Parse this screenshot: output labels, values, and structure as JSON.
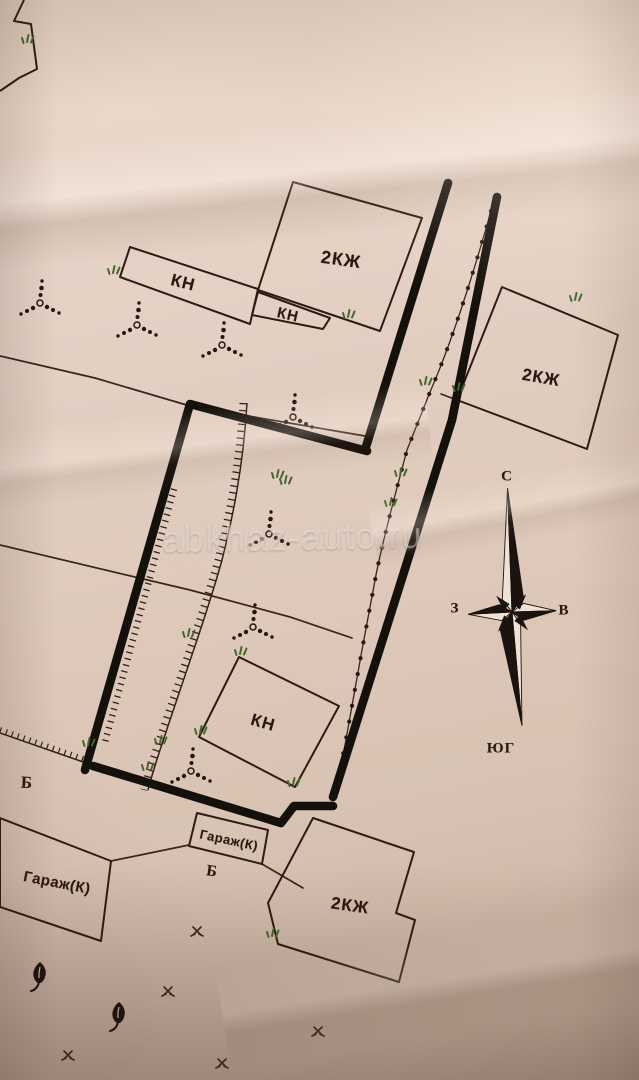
{
  "document": {
    "kind_visible": "hand-drawn land survey plan on creased paper",
    "watermark": {
      "text": "abkhaz-auto.ru"
    }
  },
  "colors": {
    "paper": "#dcc5b5",
    "ink_thin": "#3a241b",
    "ink_thick": "#14100c",
    "label_text": "#2a180f",
    "vegetation_green": "#46682e",
    "watermark": "#fcfaf6"
  },
  "compass": {
    "north_label": "С",
    "south_label": "ЮГ",
    "west_label": "З",
    "east_label": "В"
  },
  "buildings": [
    {
      "id": "kn-long-top",
      "label": "КН"
    },
    {
      "id": "kzh-top",
      "label": "2КЖ"
    },
    {
      "id": "kn-small-top",
      "label": "КН"
    },
    {
      "id": "kzh-east",
      "label": "2КЖ"
    },
    {
      "id": "kn-center",
      "label": "КН"
    },
    {
      "id": "garage-small",
      "label": "Гараж(К)"
    },
    {
      "id": "garage-large",
      "label": "Гараж(К)"
    },
    {
      "id": "kzh-bottom",
      "label": "2КЖ"
    }
  ],
  "point_markers": [
    {
      "id": "b-left",
      "label": "Б"
    },
    {
      "id": "b-center",
      "label": "Б"
    }
  ],
  "symbols": [
    {
      "icon": "tree-dots-symbol",
      "count": 7
    },
    {
      "icon": "leaf-tree-symbol",
      "count": 2
    },
    {
      "icon": "grass-symbol",
      "count": 5
    },
    {
      "icon": "green-shrub-symbol",
      "count": 18
    },
    {
      "icon": "compass-rose-icon",
      "count": 1
    }
  ]
}
